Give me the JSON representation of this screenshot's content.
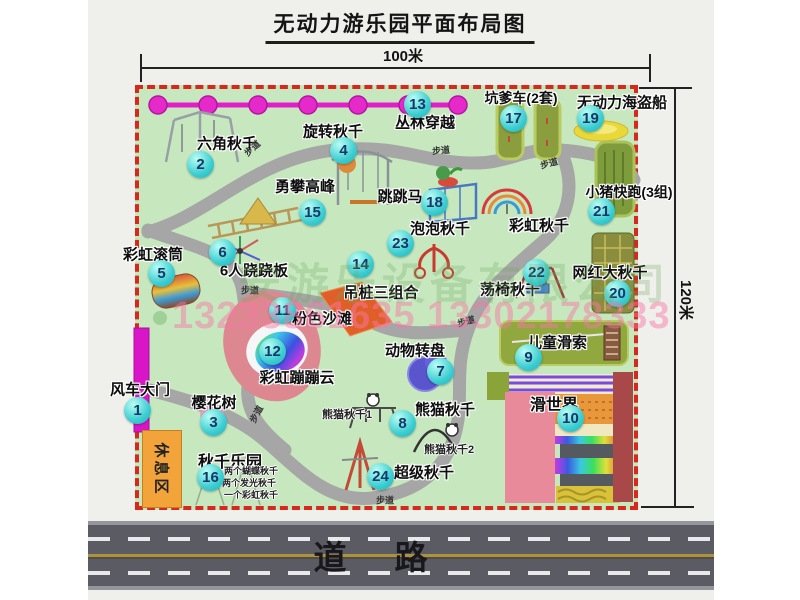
{
  "title": "无动力游乐园平面布局图",
  "dims": {
    "width_label": "100米",
    "height_label": "120米"
  },
  "road": {
    "label": "道路"
  },
  "watermark": {
    "company": "安游乐设备有限公司",
    "phone": "13233861635 13302178333"
  },
  "map": {
    "rest_area_label": "休息区",
    "path_label": "步道",
    "items": [
      {
        "n": "1",
        "label": "风车大门"
      },
      {
        "n": "2",
        "label": "六角秋千"
      },
      {
        "n": "3",
        "label": "樱花树"
      },
      {
        "n": "4",
        "label": "旋转秋千"
      },
      {
        "n": "5",
        "label": "彩虹滚筒"
      },
      {
        "n": "6",
        "label": "6人跷跷板"
      },
      {
        "n": "7",
        "label": "动物转盘"
      },
      {
        "n": "8",
        "label": "熊猫秋千"
      },
      {
        "n": "9",
        "label": "儿童滑索"
      },
      {
        "n": "10",
        "label": "滑世界"
      },
      {
        "n": "11",
        "label": "粉色沙滩"
      },
      {
        "n": "12",
        "label": "彩虹蹦蹦云"
      },
      {
        "n": "13",
        "label": "丛林穿越"
      },
      {
        "n": "14",
        "label": "吊桩三组合"
      },
      {
        "n": "15",
        "label": "勇攀高峰"
      },
      {
        "n": "16",
        "label": "秋千乐园"
      },
      {
        "n": "17",
        "label": "坑爹车(2套)"
      },
      {
        "n": "18",
        "label": "跳跳马"
      },
      {
        "n": "19",
        "label": "无动力海盗船"
      },
      {
        "n": "20",
        "label": "网红大秋千"
      },
      {
        "n": "21",
        "label": "小猪快跑(3组)"
      },
      {
        "n": "22",
        "label": "荡椅秋千"
      },
      {
        "n": "23",
        "label": "泡泡秋千"
      },
      {
        "n": "24",
        "label": "超级秋千"
      },
      {
        "n": "",
        "label": "彩虹秋千"
      }
    ],
    "sub_labels": {
      "panda1": "熊猫秋千1",
      "panda2": "熊猫秋千2",
      "swing_park_lines": [
        "两个蝴蝶秋千",
        "两个发光秋千",
        "一个彩虹秋千"
      ]
    }
  },
  "colors": {
    "map_green": "#c7e8bf",
    "border_red": "#d6281c",
    "marker_cyan": "#39ccd0",
    "chain_magenta": "#e21ec8",
    "road_gray": "#5b5b63"
  }
}
